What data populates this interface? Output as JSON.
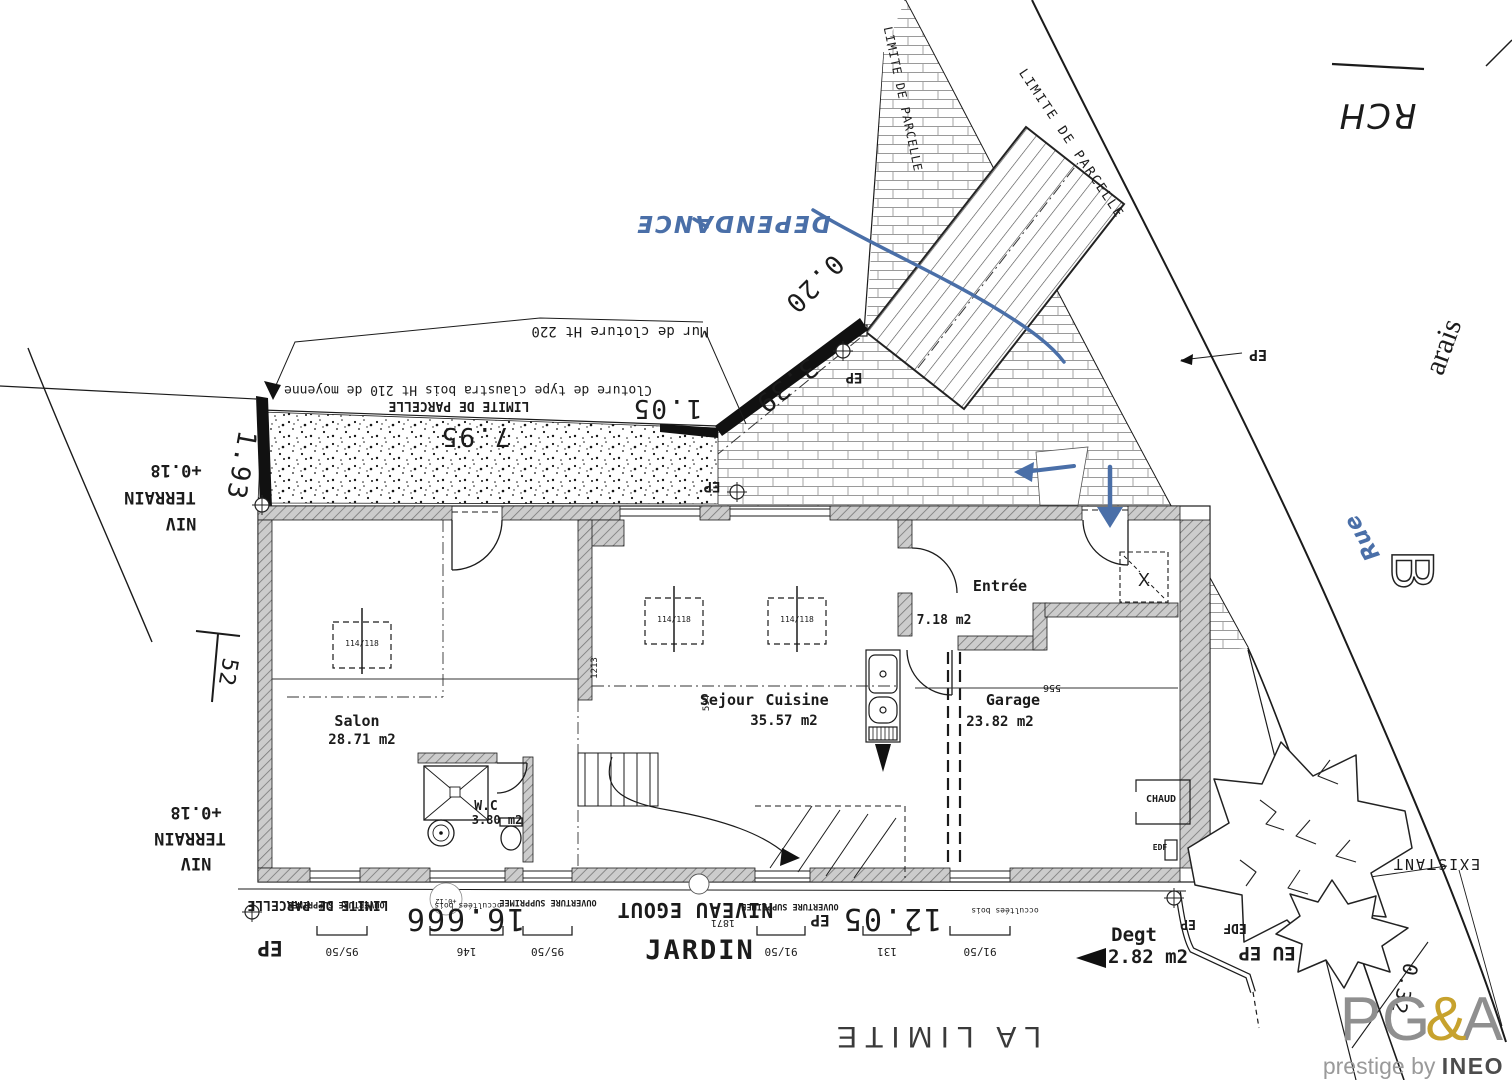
{
  "annotations": {
    "rch": "RCH",
    "arais": "arais",
    "rue": "Rue",
    "b_letter": "B",
    "dependance": "DEPENDANCE",
    "lp_road": "LIMITE DE PARCELLE",
    "lp_neck": "LIMITE DE PARCELLE",
    "lp_fence": "LIMITE DE PARCELLE",
    "lp_bottom": "LIMITE DE PARCELLE",
    "mur_cloture": "Mur de cloture Ht 220",
    "cloture_claustra": "Cloture de type claustra bois Ht 210 de moyenne",
    "d795": "7.95",
    "d105": "1.05",
    "d339": "3.39",
    "d020": "0.20",
    "d193": "1.93",
    "d52": "52",
    "niv_t1": "NIV",
    "niv_t2": "TERRAIN",
    "niv_t3": "+0.18",
    "niv_b1": "NIV",
    "niv_b2": "TERRAIN",
    "niv_b3": "+0.18",
    "ep1": "EP",
    "ep2": "EP",
    "ep3": "EP",
    "ep4": "EP",
    "ep5": "EP",
    "ep6": "EP",
    "edf_b": "EDF",
    "eu_ep": "EU EP",
    "existant": "EXISTANT",
    "salon": "Salon",
    "salon_area": "28.71 m2",
    "sejour": "Sejour",
    "cuisine": "Cuisine",
    "sejour_area": "35.57 m2",
    "entree": "Entrée",
    "entree_area": "7.18 m2",
    "garage": "Garage",
    "garage_area": "23.82 m2",
    "wc": "W.C",
    "wc_area": "3.80 m2",
    "chaud": "CHAUD",
    "edf_g": "EDF",
    "xmark": "X",
    "rw1": "114/118",
    "rw2": "114/118",
    "rw3": "114/118",
    "d1213": "1213",
    "d594": "594",
    "d556": "556",
    "jardin": "JARDIN",
    "negout": "NIVEAU EGOUT",
    "d16666": "16.666",
    "d1205": "12.05",
    "d1871": "1871",
    "os1": "OUVERTURE SUPPRIMEE",
    "os2": "OUVERTURE SUPPRIMEE",
    "os3": "OUVERTURE SUPPRIMEE",
    "ob1": "occultées bois",
    "ob2": "occultées bois",
    "p012": "+0.12",
    "degt": "Degt",
    "degt_area": "2.82 m2",
    "la_limite": "LA LIMITE",
    "d032": "0.32"
  },
  "dim_chains": [
    "95/50",
    "146",
    "95/50",
    "91/50",
    "131",
    "91/50"
  ],
  "logo": {
    "pg": "PG",
    "amp": "&",
    "a": "A",
    "tagline": "prestige by ",
    "brand": "INEO"
  },
  "colors": {
    "ink": "#1b1b1b",
    "blue_annotation": "#4a6fa8",
    "logo_gray": "#8f8f8f",
    "logo_gold": "#c7a22d",
    "logo_brand": "#4c4c4c"
  }
}
